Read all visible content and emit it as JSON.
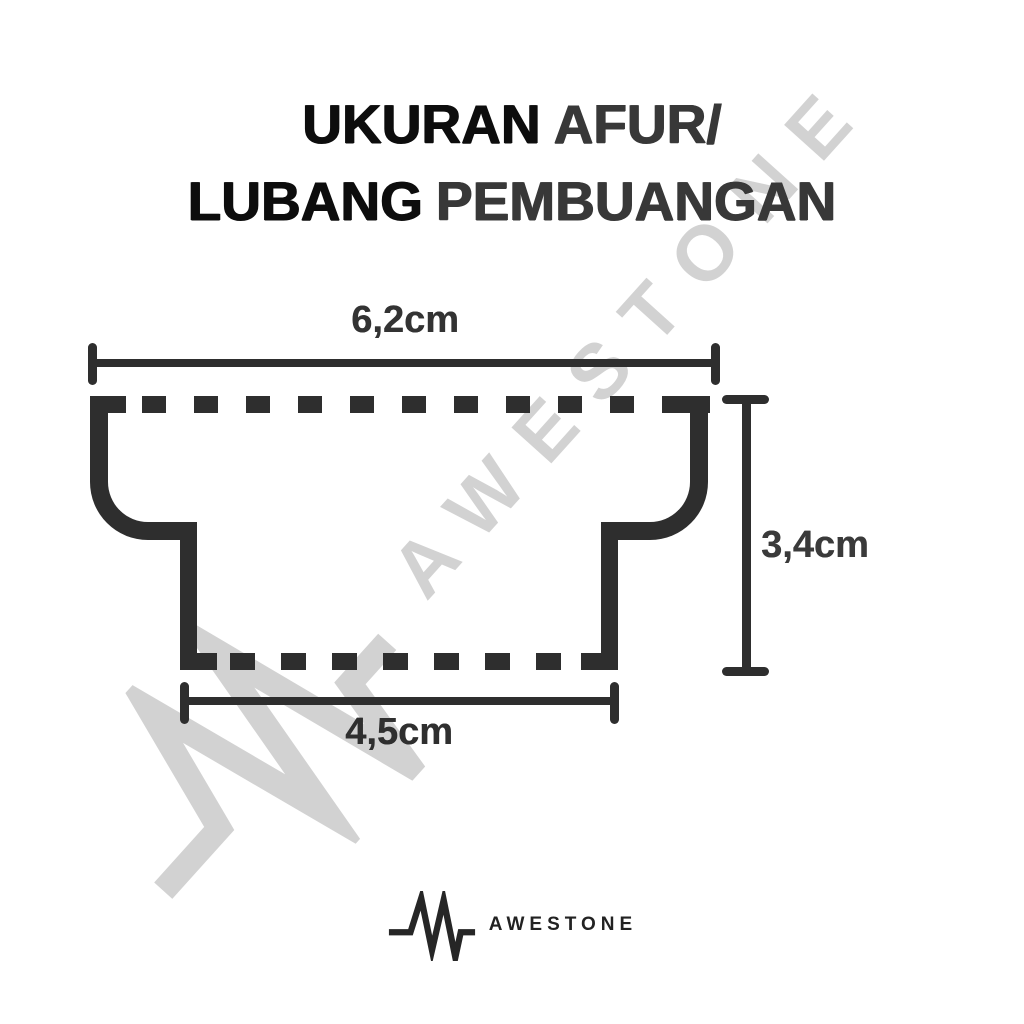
{
  "title": {
    "line1": {
      "primary": "UKURAN",
      "accent": "AFUR/"
    },
    "line2": {
      "primary": "LUBANG",
      "accent": "PEMBUANGAN"
    }
  },
  "diagram": {
    "type": "drain-hole-cross-section",
    "dimensions": {
      "top_width_label": "6,2cm",
      "depth_label": "3,4cm",
      "bottom_width_label": "4,5cm"
    }
  },
  "watermark": {
    "text": "AWESTONE",
    "icon": "pulse-wave-icon",
    "color": "#d2d2d2"
  },
  "brand": {
    "name": "AWESTONE",
    "icon": "pulse-wave-icon"
  },
  "colors": {
    "background": "#ffffff",
    "ink_primary": "#0d0d0d",
    "ink_secondary": "#383838",
    "line": "#2e2e2e",
    "watermark": "#d2d2d2"
  }
}
